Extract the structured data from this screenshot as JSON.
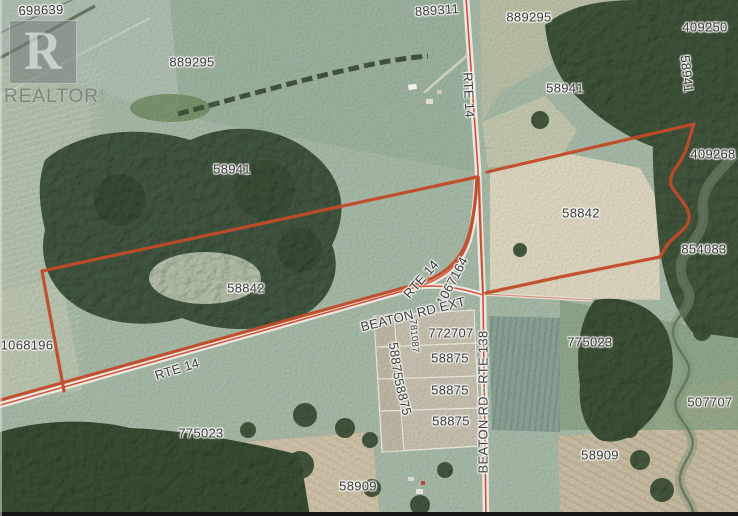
{
  "watermark": {
    "logo_letter": "R",
    "wordmark": "REALTOR",
    "registered": "®"
  },
  "colors": {
    "boundary": "#c14b29",
    "road_centerline": "#d0523a",
    "label_text": "#3c3c3c",
    "forest": "#3e5339",
    "field": "#a7b9a7"
  },
  "map_labels": [
    {
      "text": "698639",
      "kind": "parcel",
      "x": 41,
      "y": 10,
      "rot": -2
    },
    {
      "text": "889295",
      "kind": "parcel",
      "x": 192,
      "y": 62,
      "rot": 0
    },
    {
      "text": "889311",
      "kind": "parcel",
      "x": 437,
      "y": 10,
      "rot": -4
    },
    {
      "text": "889295",
      "kind": "parcel",
      "x": 529,
      "y": 17,
      "rot": 0
    },
    {
      "text": "409250",
      "kind": "parcel",
      "x": 705,
      "y": 27,
      "rot": 0
    },
    {
      "text": "58941",
      "kind": "parcel",
      "x": 687,
      "y": 74,
      "rot": 84
    },
    {
      "text": "58941",
      "kind": "parcel",
      "x": 565,
      "y": 88,
      "rot": 0
    },
    {
      "text": "58941",
      "kind": "parcel",
      "x": 232,
      "y": 169,
      "rot": 0
    },
    {
      "text": "409268",
      "kind": "parcel",
      "x": 713,
      "y": 154,
      "rot": 0
    },
    {
      "text": "58842",
      "kind": "parcel",
      "x": 581,
      "y": 213,
      "rot": 0
    },
    {
      "text": "854083",
      "kind": "parcel",
      "x": 704,
      "y": 249,
      "rot": 0
    },
    {
      "text": "58842",
      "kind": "parcel",
      "x": 246,
      "y": 288,
      "rot": 0
    },
    {
      "text": "1067164",
      "kind": "parcel",
      "x": 452,
      "y": 281,
      "rot": -62
    },
    {
      "text": "1068196",
      "kind": "parcel",
      "x": 27,
      "y": 345,
      "rot": 0
    },
    {
      "text": "772707",
      "kind": "parcel",
      "x": 451,
      "y": 333,
      "rot": 0
    },
    {
      "text": "781087",
      "kind": "parcel",
      "x": 414,
      "y": 336,
      "rot": 85,
      "size": 9.5
    },
    {
      "text": "58875",
      "kind": "parcel",
      "x": 396,
      "y": 361,
      "rot": 82
    },
    {
      "text": "58875",
      "kind": "parcel",
      "x": 403,
      "y": 397,
      "rot": 76
    },
    {
      "text": "58875",
      "kind": "parcel",
      "x": 450,
      "y": 358,
      "rot": 0
    },
    {
      "text": "58875",
      "kind": "parcel",
      "x": 450,
      "y": 390,
      "rot": 0
    },
    {
      "text": "58875",
      "kind": "parcel",
      "x": 451,
      "y": 421,
      "rot": 0
    },
    {
      "text": "775023",
      "kind": "parcel",
      "x": 201,
      "y": 433,
      "rot": 0
    },
    {
      "text": "775023",
      "kind": "parcel",
      "x": 590,
      "y": 342,
      "rot": 0
    },
    {
      "text": "507707",
      "kind": "parcel",
      "x": 710,
      "y": 402,
      "rot": 0
    },
    {
      "text": "58909",
      "kind": "parcel",
      "x": 358,
      "y": 486,
      "rot": 0
    },
    {
      "text": "58909",
      "kind": "parcel",
      "x": 600,
      "y": 455,
      "rot": 0
    },
    {
      "text": "RTE 14",
      "kind": "road",
      "x": 469,
      "y": 95,
      "rot": 87
    },
    {
      "text": "RTE 14",
      "kind": "road",
      "x": 421,
      "y": 279,
      "rot": -49
    },
    {
      "text": "RTE 14",
      "kind": "road",
      "x": 177,
      "y": 369,
      "rot": -17
    },
    {
      "text": "BEATON RD EXT",
      "kind": "road",
      "x": 413,
      "y": 314,
      "rot": -14
    },
    {
      "text": "BEATON RD - RTE 138",
      "kind": "road",
      "x": 483,
      "y": 402,
      "rot": -90
    }
  ]
}
